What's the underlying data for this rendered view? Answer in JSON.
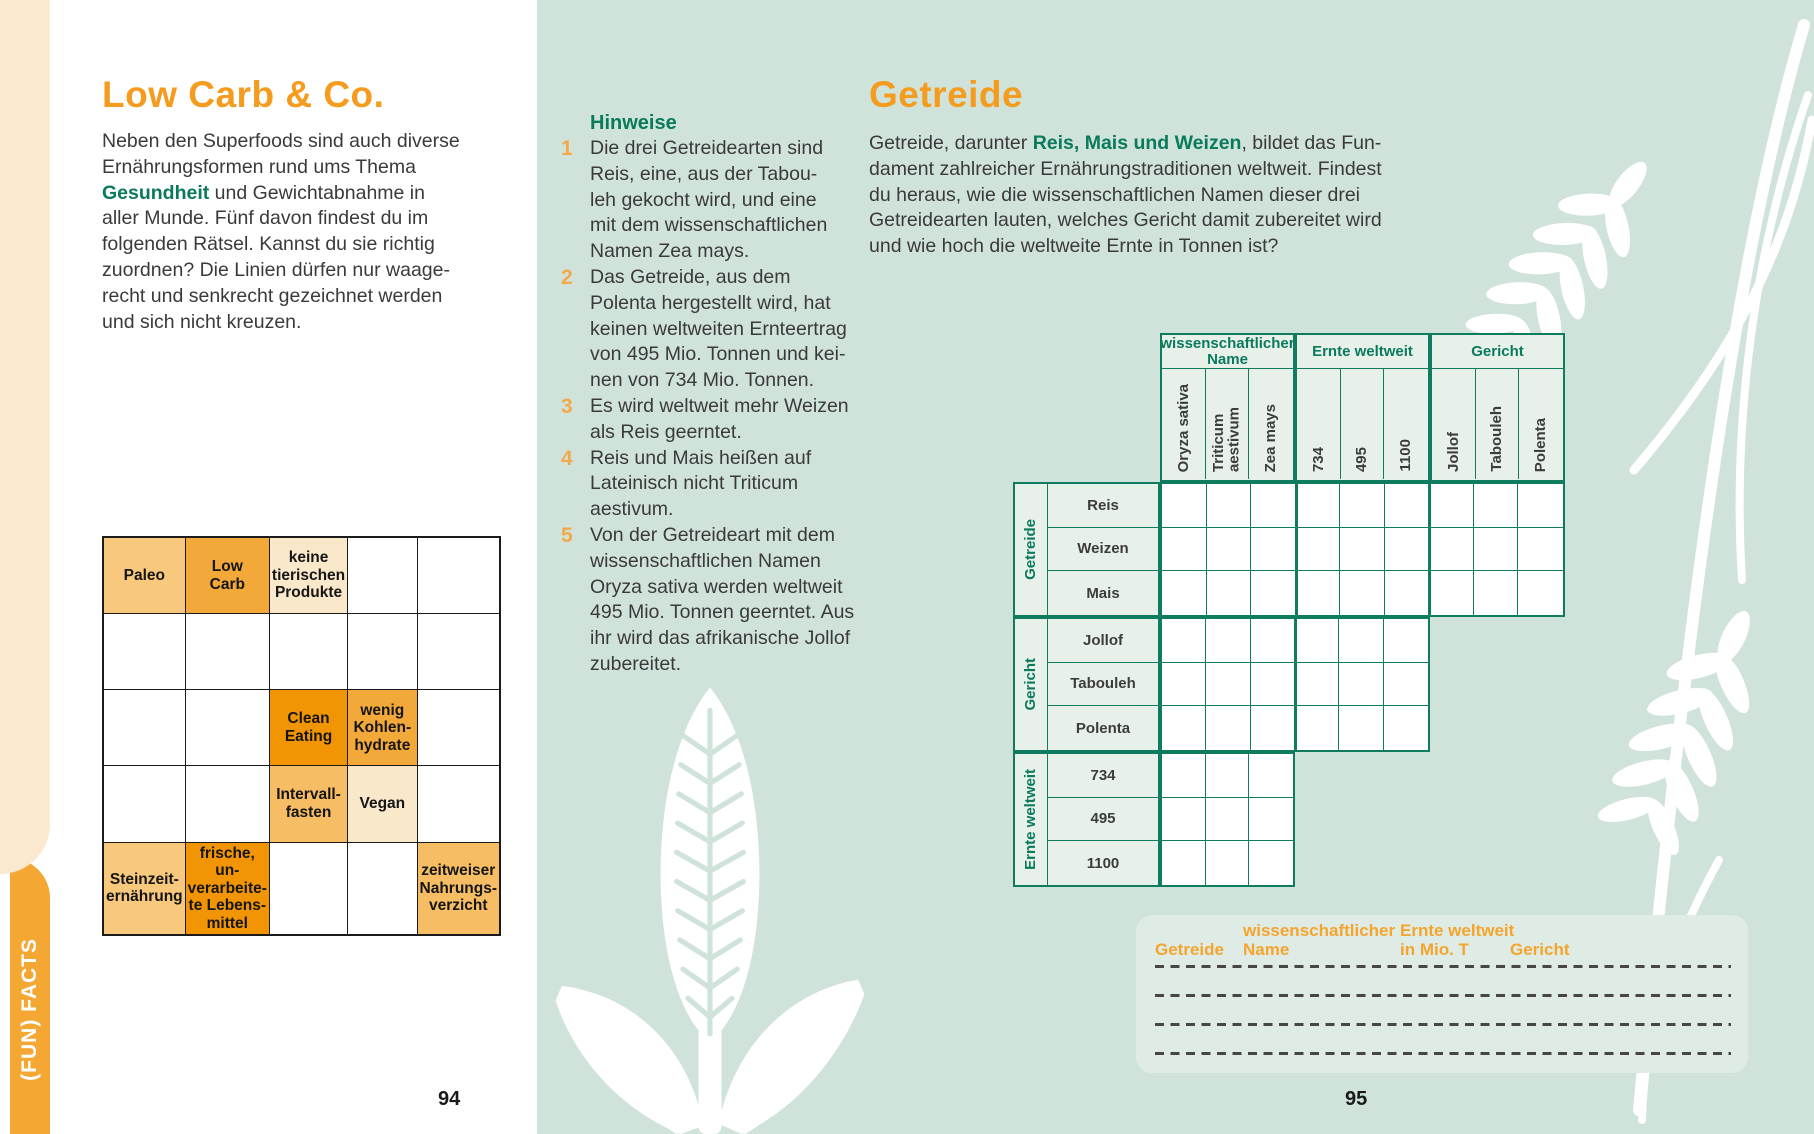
{
  "colors": {
    "orange_title": "#f59b1e",
    "green_text": "#0a7a5c",
    "grid_green": "#0f7b5f",
    "page_green": "#d0e3da",
    "panel_green": "#dfece6",
    "sidebar_orange": "#f5a733",
    "cream": "#fae8cf",
    "cell_light": "#f8c87c",
    "cell_medium": "#f3a83a",
    "cell_strong": "#f29504",
    "cell_cream": "#fae8cb",
    "cell_soft": "#f6bd65"
  },
  "sidebar": {
    "label": "(FUN) FACTS"
  },
  "left_page": {
    "title": "Low Carb & Co.",
    "intro_pre": "Neben den Superfoods sind auch diverse\nErnährungsformen rund ums Thema\n",
    "intro_highlight": "Gesundheit",
    "intro_post": " und Gewichtabnahme in\naller Munde. Fünf davon findest du im\nfolgenden Rätsel. Kannst du sie richtig\nzuordnen? Die Linien dürfen nur waage-\nrecht und senkrecht gezeichnet werden\nund sich nicht kreuzen.",
    "page_number": "94",
    "grid": {
      "rows": 5,
      "cols": 5,
      "cells": [
        {
          "row": 0,
          "col": 0,
          "text": "Paleo",
          "tone": "light"
        },
        {
          "row": 0,
          "col": 1,
          "text": "Low\nCarb",
          "tone": "medium"
        },
        {
          "row": 0,
          "col": 2,
          "text": "keine\ntierischen\nProdukte",
          "tone": "cream"
        },
        {
          "row": 2,
          "col": 2,
          "text": "Clean\nEating",
          "tone": "strong"
        },
        {
          "row": 2,
          "col": 3,
          "text": "wenig\nKohlen-\nhydrate",
          "tone": "medium"
        },
        {
          "row": 3,
          "col": 2,
          "text": "Intervall-\nfasten",
          "tone": "soft"
        },
        {
          "row": 3,
          "col": 3,
          "text": "Vegan",
          "tone": "cream"
        },
        {
          "row": 4,
          "col": 0,
          "text": "Steinzeit-\nernährung",
          "tone": "light"
        },
        {
          "row": 4,
          "col": 1,
          "text": "frische, un-\nverarbeite-\nte Lebens-\nmittel",
          "tone": "strong"
        },
        {
          "row": 4,
          "col": 4,
          "text": "zeitweiser\nNahrungs-\nverzicht",
          "tone": "soft"
        }
      ]
    }
  },
  "hints": {
    "title": "Hinweise",
    "items": [
      {
        "num": "1",
        "text": "Die drei Getreidearten sind\nReis, eine, aus der Tabou-\nleh gekocht wird, und eine\nmit dem wissenschaftlichen\nNamen Zea mays."
      },
      {
        "num": "2",
        "text": "Das Getreide, aus dem\nPolenta hergestellt wird, hat\nkeinen weltweiten Ernteertrag\nvon 495 Mio. Tonnen und kei-\nnen von 734 Mio. Tonnen."
      },
      {
        "num": "3",
        "text": "Es wird weltweit mehr Weizen\nals Reis geerntet."
      },
      {
        "num": "4",
        "text": "Reis und Mais heißen auf\nLateinisch nicht Triticum\naestivum."
      },
      {
        "num": "5",
        "text": "Von der Getreideart mit dem\nwissenschaftlichen Namen\nOryza sativa werden weltweit\n495 Mio. Tonnen geerntet. Aus\nihr wird das afrikanische Jollof\nzubereitet."
      }
    ]
  },
  "right_page": {
    "title": "Getreide",
    "intro_pre": "Getreide, darunter ",
    "intro_highlight": "Reis, Mais und Weizen",
    "intro_post": ", bildet das Fun-\ndament zahlreicher Ernährungstraditionen weltweit. Findest\ndu heraus, wie die wissenschaftlichen Namen dieser drei\nGetreidearten lauten, welches Gericht damit zubereitet wird\nund wie hoch die weltweite Ernte in Tonnen ist?",
    "page_number": "95",
    "puzzle": {
      "col_groups": [
        "wissenschaftlicher\nName",
        "Ernte weltweit",
        "Gericht"
      ],
      "col_labels": [
        "Oryza sativa",
        "Triticum\naestivum",
        "Zea mays",
        "734",
        "495",
        "1100",
        "Jollof",
        "Tabouleh",
        "Polenta"
      ],
      "row_groups": [
        "Getreide",
        "Gericht",
        "Ernte weltweit"
      ],
      "row_labels": [
        "Reis",
        "Weizen",
        "Mais",
        "Jollof",
        "Tabouleh",
        "Polenta",
        "734",
        "495",
        "1100"
      ],
      "block_cols": [
        9,
        6,
        3
      ]
    },
    "answer_panel": {
      "headers": [
        "Getreide",
        "wissenschaftlicher\nName",
        "Ernte weltweit\nin Mio. T",
        "Gericht"
      ],
      "line_count": 4
    }
  }
}
